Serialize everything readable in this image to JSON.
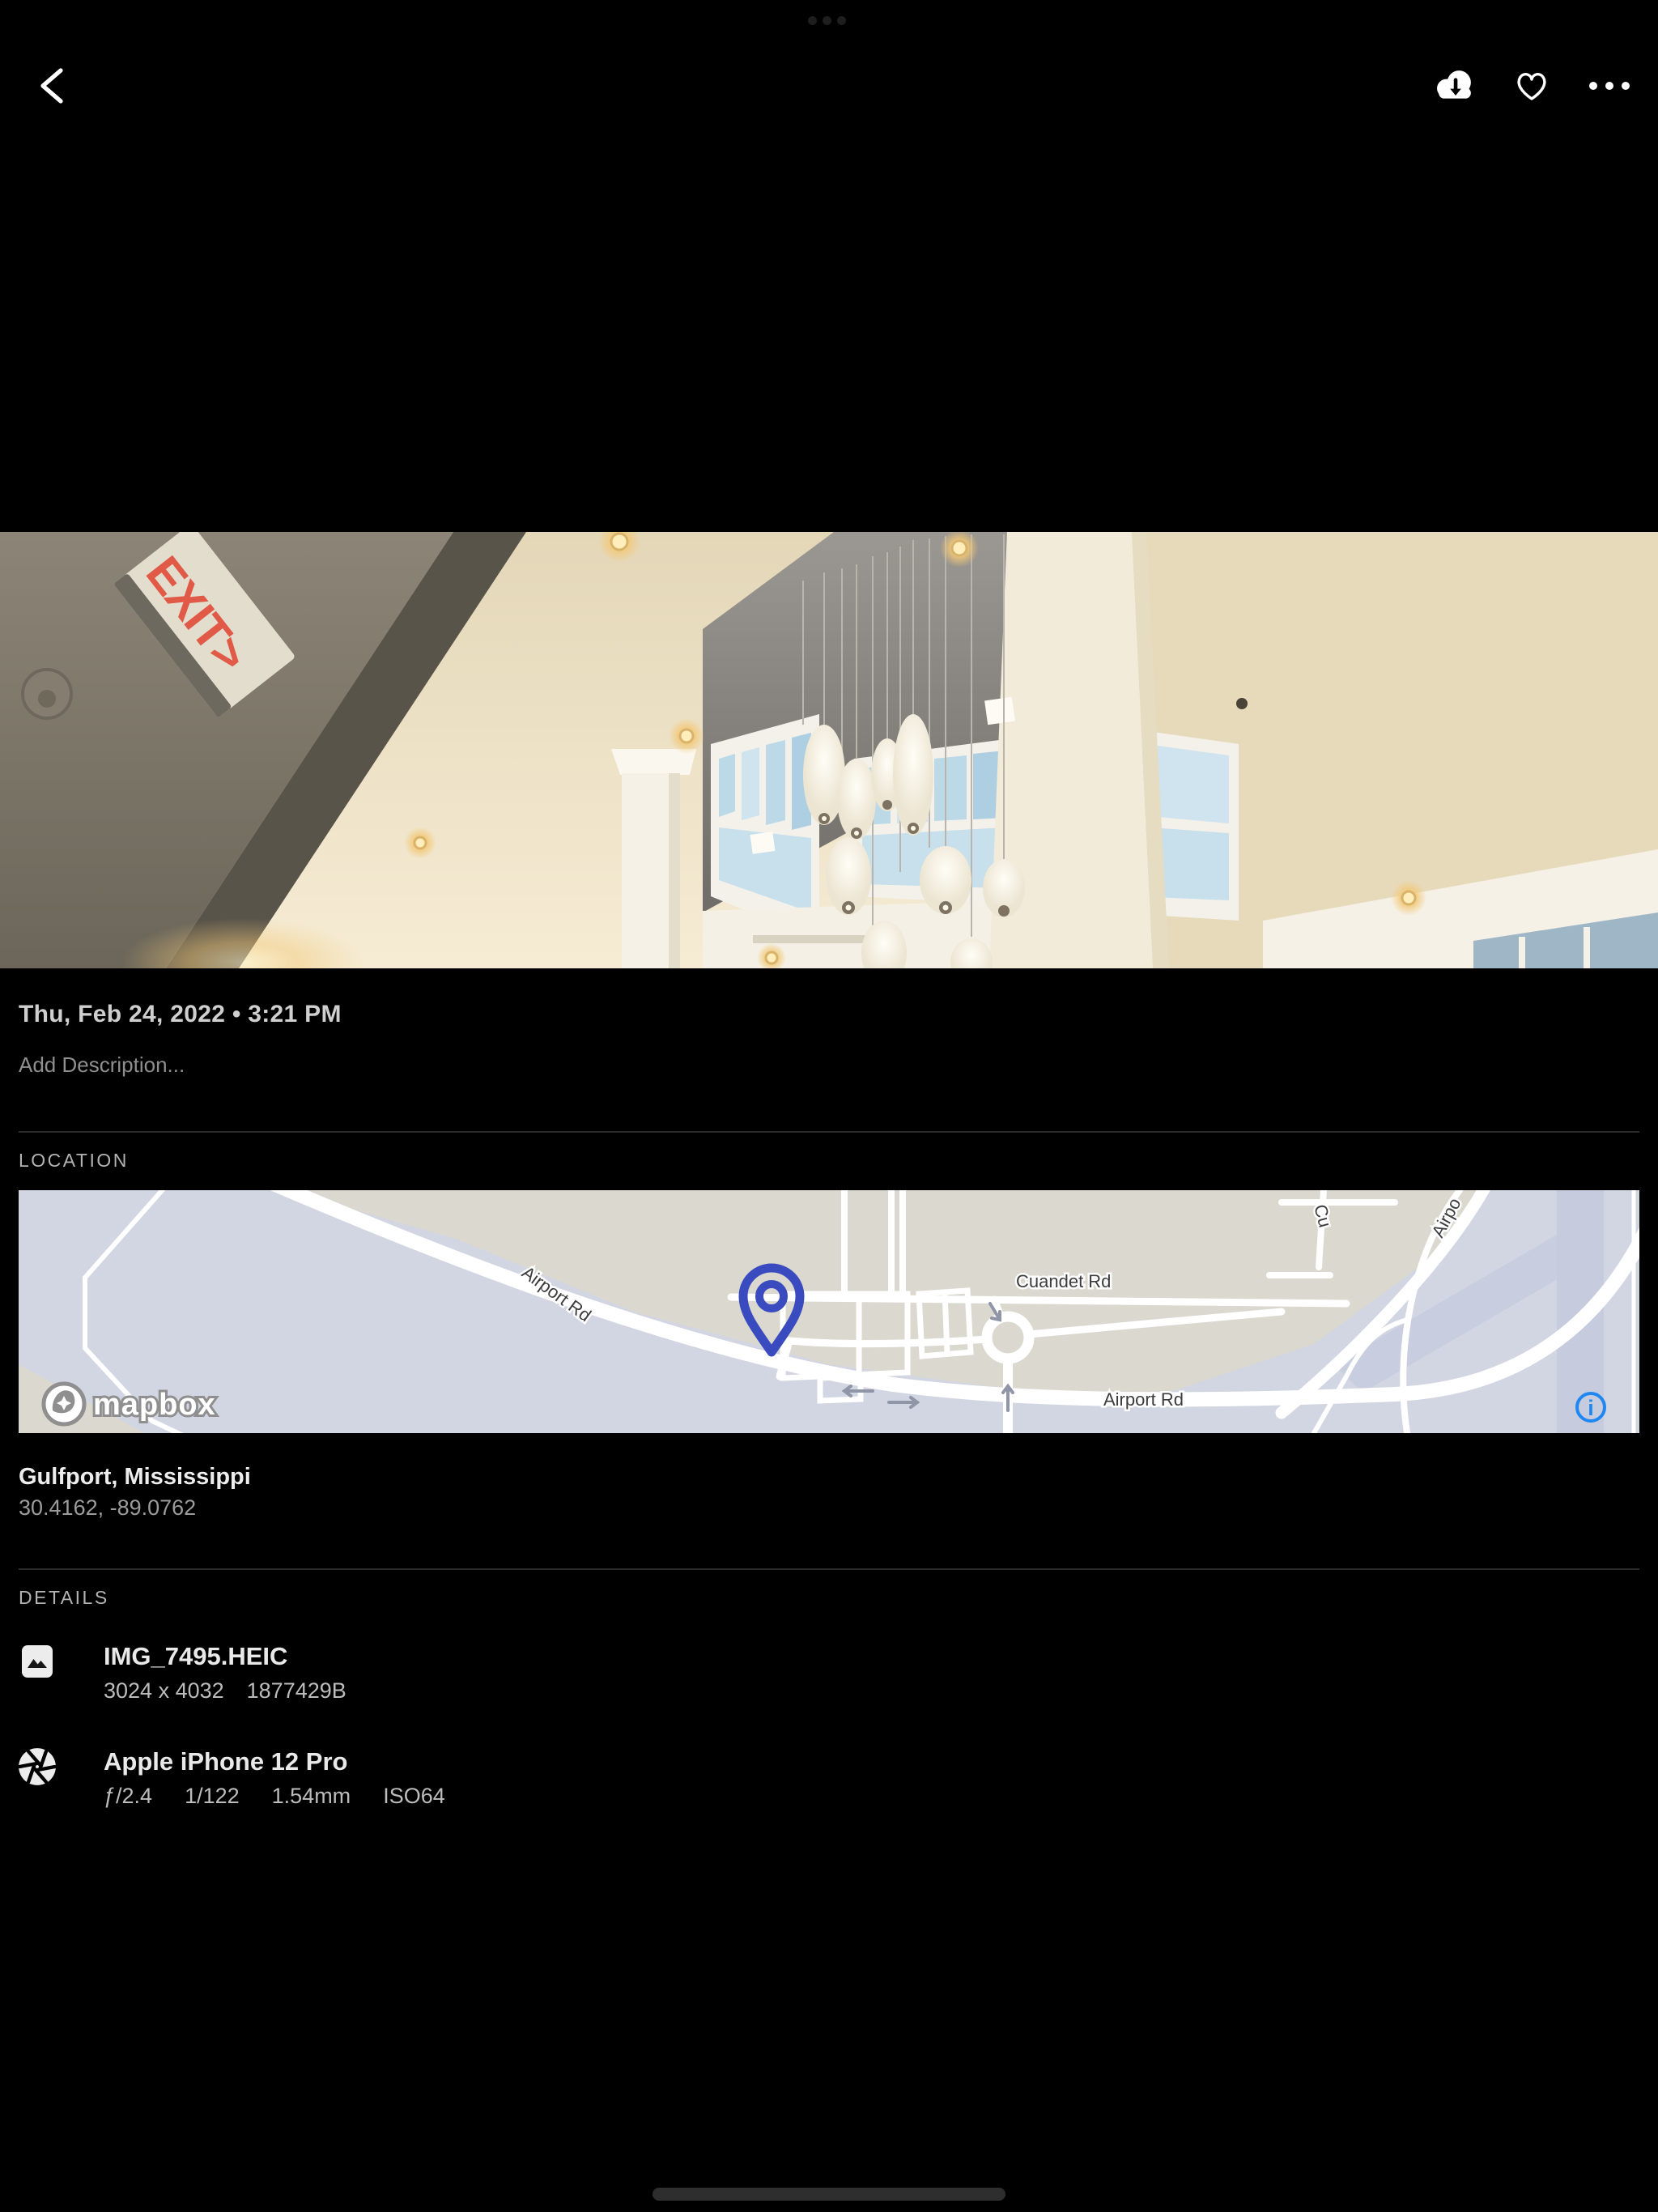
{
  "toolbar": {
    "back_icon": "chevron-left",
    "download_icon": "cloud-download",
    "favorite_icon": "heart-outline",
    "more_icon": "ellipsis"
  },
  "photo": {
    "exit_sign_text": "EXIT>"
  },
  "metadata": {
    "datetime": "Thu, Feb 24, 2022 • 3:21 PM",
    "description_placeholder": "Add Description..."
  },
  "location": {
    "section_label": "LOCATION",
    "place": "Gulfport, Mississippi",
    "coordinates": "30.4162, -89.0762",
    "map": {
      "label_airport_rd_nw": "Airport Rd",
      "label_cuandet_rd": "Cuandet Rd",
      "label_airport_rd_s": "Airport Rd",
      "label_partial_cu": "Cu",
      "label_partial_airport": "Airpo",
      "attribution": "mapbox",
      "info_icon": "i"
    }
  },
  "details": {
    "section_label": "DETAILS",
    "file": {
      "name": "IMG_7495.HEIC",
      "dimensions": "3024 x 4032",
      "size_bytes": "1877429B"
    },
    "camera": {
      "name": "Apple iPhone 12 Pro",
      "aperture": "ƒ/2.4",
      "exposure": "1/122",
      "focal_length": "1.54mm",
      "iso": "ISO64"
    }
  },
  "colors": {
    "accent_blue": "#1f87f2",
    "pin_indigo": "#3a4bbf",
    "map_land": "#dbd8cf",
    "map_water": "#d2d5e2"
  }
}
